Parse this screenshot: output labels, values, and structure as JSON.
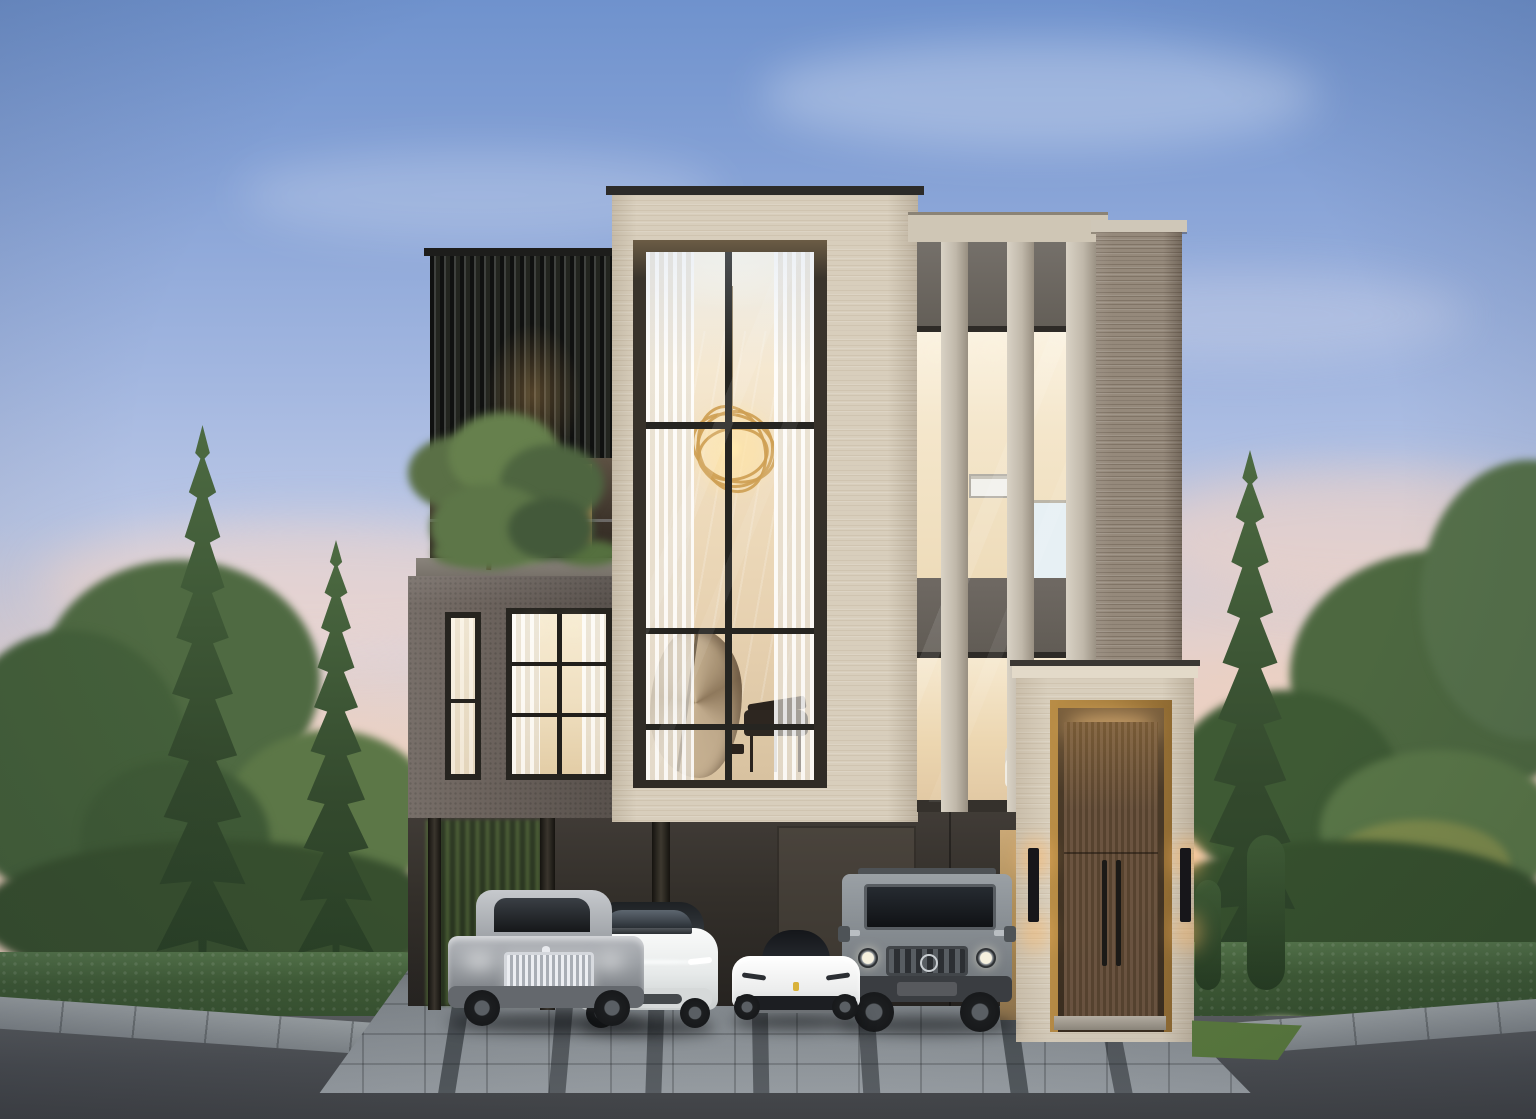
{
  "meta": {
    "description": "Dusk exterior rendering of a modern three-storey luxury house with four cars parked in an under-croft carport",
    "width_px": 1536,
    "height_px": 1119
  },
  "sky": {
    "top_color": "#6f92cd",
    "mid_color": "#b7c6e4",
    "horizon_color": "#f0d3c0",
    "clouds": "soft pink wisps near horizon"
  },
  "building": {
    "facade_materials": {
      "central_tower": "#d8cebc",
      "right_tower": "#95897b",
      "second_floor_volume": "#6f6660",
      "louver_screen": "#2b2d2a",
      "stone_fins": "#c4bcae"
    },
    "features": [
      "double-height glazed atrium",
      "gold spiral chandelier",
      "spiral staircase",
      "grand piano silhouette",
      "vertical louver screen box",
      "roof terrace with tree and glass balustrade",
      "three vertical stone fins over curtain wall",
      "dark travertine tower",
      "recessed timber entrance door with brass surround",
      "black wall sconces with warm light",
      "carport for four cars"
    ]
  },
  "interior_lighting": {
    "glow_color": "#f3e3c2",
    "chandelier_color": "#c99a4e"
  },
  "entrance": {
    "door_color": "#5f4a35",
    "trim_color": "#a87f3e",
    "sconce_color": "#17161a",
    "step_color": "#b9b2a6"
  },
  "vehicles": [
    {
      "position": 1,
      "description": "silver luxury coupe with vertical chrome grille"
    },
    {
      "position": 2,
      "description": "white electric crossover SUV with front light bar"
    },
    {
      "position": 3,
      "description": "white mid-engine sports car with black canopy"
    },
    {
      "position": 4,
      "description": "grey boxy off-road SUV with roof rack and round headlights"
    }
  ],
  "landscape": {
    "hedge_color": "#3f5b36",
    "flower_colors": [
      "#8a6fae",
      "#b78fc0",
      "#e6e0d2"
    ],
    "trees": [
      "tall narrow conifers",
      "rounded deciduous trees",
      "columnar juniper"
    ],
    "grass_color": "#5a7a3e"
  },
  "ground": {
    "paver_color": "#8d9398",
    "paver_strip_color": "#31363b",
    "asphalt_color": "#4b4e52",
    "sidewalk_color": "#979da1"
  }
}
